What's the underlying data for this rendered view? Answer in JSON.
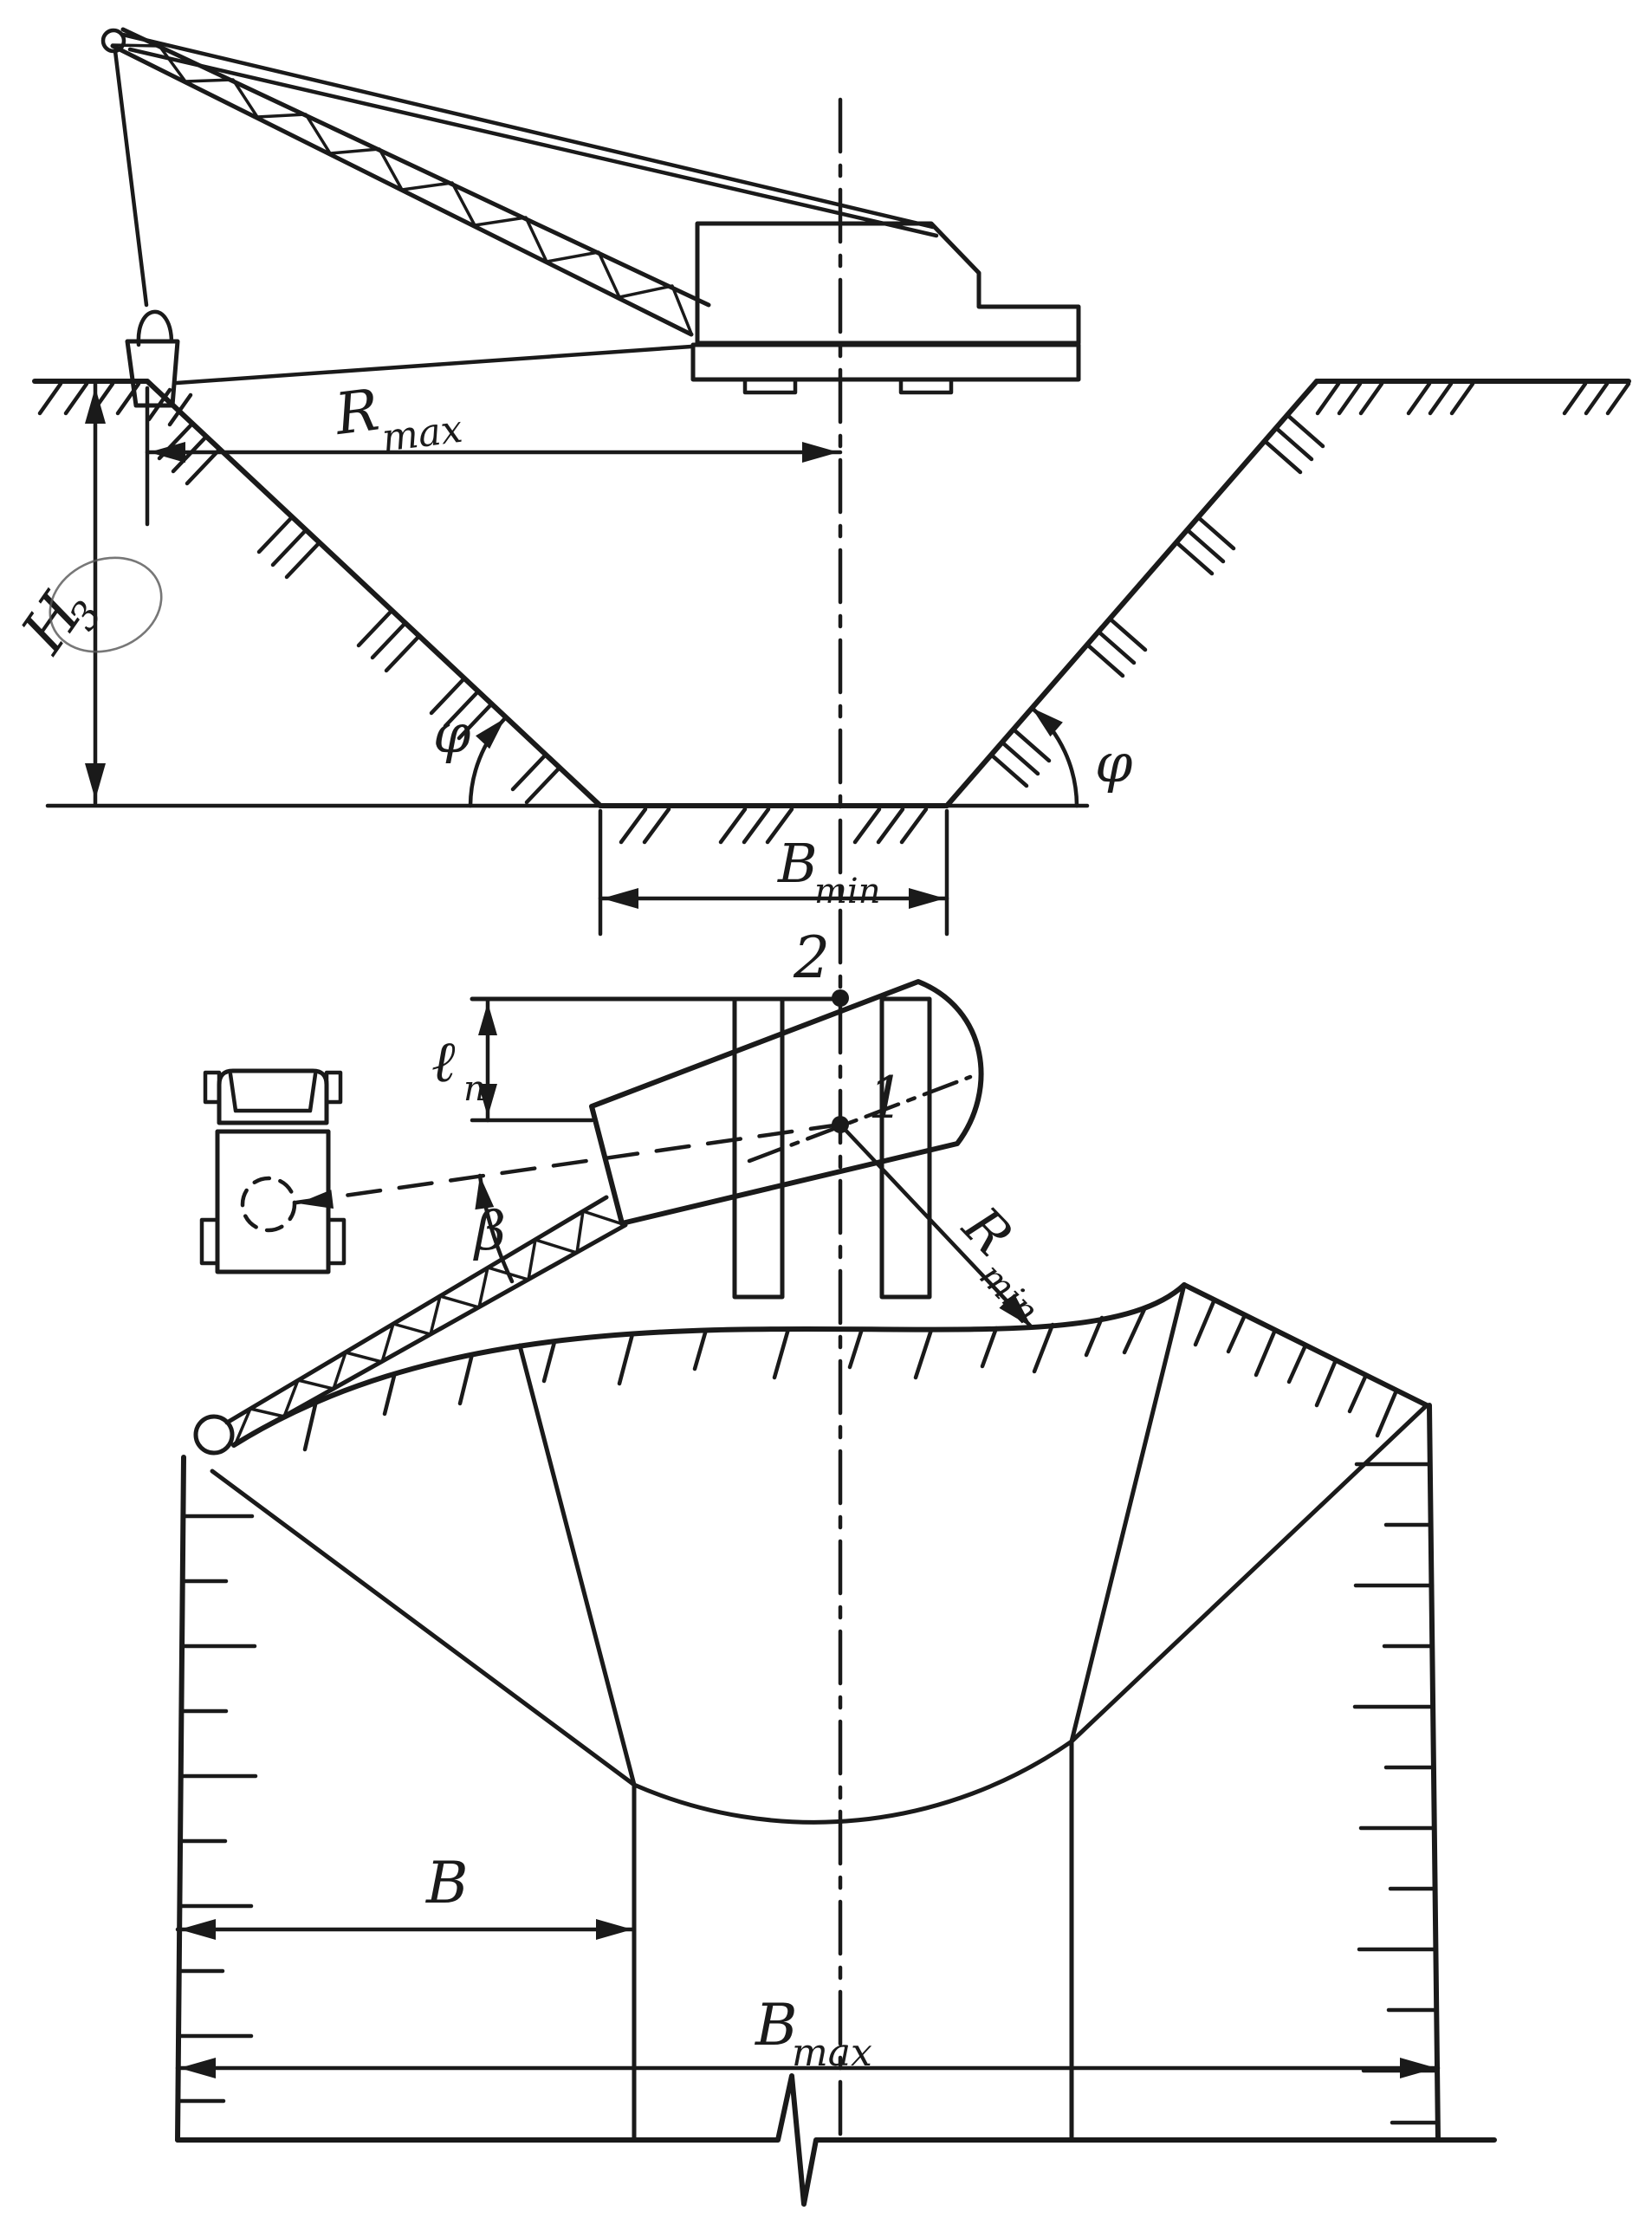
{
  "figure_type": "dragline-trench-excavation-scheme",
  "views": {
    "top": "side cross-section of dragline excavator and trench",
    "bottom": "plan view of dragline, dump truck and excavation fan"
  },
  "labels": {
    "h_depth": {
      "base": "H",
      "sub": "3"
    },
    "r_max": {
      "base": "R",
      "sub": "max"
    },
    "phi_left": "φ",
    "phi_right": "φ",
    "b_min": {
      "base": "B",
      "sub": "min"
    },
    "point_upper": "2",
    "point_lower": "1",
    "step": {
      "base": "ℓ",
      "sub": "n"
    },
    "beta": "β",
    "r_min": {
      "base": "R",
      "sub": "min"
    },
    "b": "B",
    "b_max": {
      "base": "B",
      "sub": "max"
    }
  },
  "colors": {
    "ink": "#1a1a1a",
    "paper": "#ffffff"
  }
}
